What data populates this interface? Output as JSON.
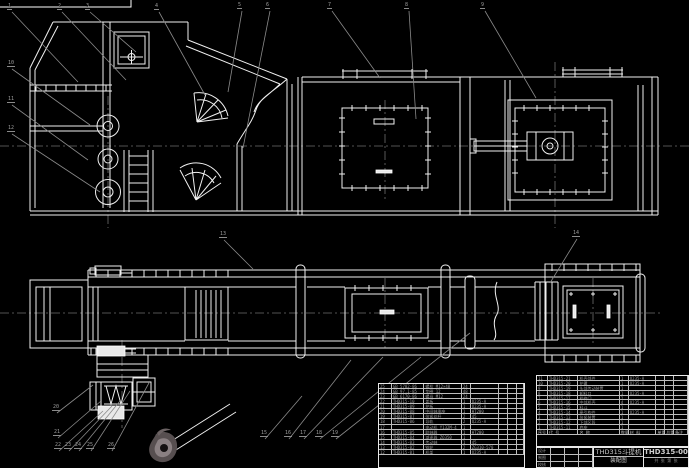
{
  "drawing": {
    "title": "THD315斗提机",
    "subtitle": "装配图",
    "drawing_number": "THD315-00",
    "title_note": "共 张  第 张",
    "colors": {
      "background": "#000000",
      "line": "#f0f0f0",
      "leader": "#8a8a8a",
      "centerline": "#6e6e6e",
      "table_text": "#9a9a9a"
    }
  },
  "title_block": {
    "signature_labels": [
      "设计",
      "制图",
      "校核"
    ]
  },
  "bom_right": {
    "header": [
      "序号",
      "代 号",
      "名 称",
      "数量",
      "材 料",
      "单重",
      "总重",
      "备注"
    ],
    "col_widths": [
      11,
      31,
      42,
      9,
      28,
      9,
      9,
      14
    ],
    "rows": [
      [
        "11",
        "THD315-21",
        "机壳部件",
        "1",
        "Q235-A",
        "",
        "",
        " "
      ],
      [
        "10",
        "THD315-20",
        "护罩",
        "1",
        "Q235-A",
        "",
        "",
        " "
      ],
      [
        "9",
        "THD315-19",
        "头部传动装置",
        "1",
        "",
        "",
        "",
        " "
      ],
      [
        "8",
        "THD315-18",
        "卸料口",
        "1",
        "Q235-A",
        "",
        "",
        " "
      ],
      [
        "7",
        "THD315-17",
        "检修门",
        "2",
        "",
        "",
        "",
        " "
      ],
      [
        "6",
        "THD315-16",
        "中部机壳",
        "4",
        "Q235-A",
        "",
        "",
        " "
      ],
      [
        "5",
        "THD315-15",
        "料斗",
        "1",
        "",
        "",
        "",
        " "
      ],
      [
        "4",
        "THD315-14",
        "牵引构件",
        "1",
        "Q235-A",
        "",
        "",
        " "
      ],
      [
        "3",
        "THD315-13",
        "张紧装置",
        "1",
        "",
        "",
        "",
        " "
      ],
      [
        "2",
        "THD315-12",
        "下部区段",
        "1",
        "",
        "",
        "",
        " "
      ],
      [
        "1",
        "THD315-11",
        "底座",
        "1",
        "",
        "",
        "",
        " "
      ]
    ]
  },
  "bom_left": {
    "col_widths": [
      13,
      33,
      38,
      9,
      29,
      9,
      9,
      7
    ],
    "rows": [
      [
        "25",
        "GB 5782-86",
        "螺栓 M12×40",
        "24",
        "",
        "",
        "",
        " "
      ],
      [
        "24",
        "GB 97.1-85",
        "垫圈 12",
        "48",
        "",
        "",
        "",
        " "
      ],
      [
        "23",
        "GB 6170-86",
        "螺母 M12",
        "24",
        "",
        "",
        "",
        " "
      ],
      [
        "22",
        "THD315-10",
        "盖板",
        "1",
        "Q235-A",
        "",
        "",
        " "
      ],
      [
        "21",
        "THD315-09",
        "护板",
        "1",
        "Q235-A",
        "",
        "",
        " "
      ],
      [
        "20",
        "THD315-08",
        "中间轴承座",
        "1",
        "HT200",
        "",
        "",
        " "
      ],
      [
        "19",
        "THD315-07",
        "张紧丝杆",
        "2",
        "45",
        "",
        "",
        " "
      ],
      [
        "18",
        "THD315-06",
        "导轨",
        "2",
        "Q235-A",
        "",
        "",
        " "
      ],
      [
        "17",
        "",
        "电动机 Y132M-4",
        "1",
        "",
        "",
        "",
        " "
      ],
      [
        "16",
        "THD315-05",
        "联轴器",
        "1",
        "HT200",
        "",
        "",
        " "
      ],
      [
        "15",
        "THD315-04",
        "减速器 ZQ350",
        "1",
        "",
        "",
        "",
        " "
      ],
      [
        "14",
        "THD315-03",
        "传动轴",
        "1",
        "45",
        "",
        "",
        " "
      ],
      [
        "13",
        "THD315-02",
        "链轮",
        "2",
        "ZG310-570",
        "",
        "",
        " "
      ],
      [
        "12",
        "THD315-01",
        "机架",
        "1",
        "Q235-A",
        "",
        "",
        " "
      ]
    ]
  },
  "callouts": [
    {
      "label": "1",
      "x": 10,
      "y": 10,
      "tx": 78,
      "ty": 82
    },
    {
      "label": "2",
      "x": 60,
      "y": 10,
      "tx": 126,
      "ty": 80
    },
    {
      "label": "3",
      "x": 88,
      "y": 10,
      "tx": 136,
      "ty": 52
    },
    {
      "label": "4",
      "x": 157,
      "y": 10,
      "tx": 205,
      "ty": 95
    },
    {
      "label": "5",
      "x": 240,
      "y": 9,
      "tx": 228,
      "ty": 92
    },
    {
      "label": "6",
      "x": 268,
      "y": 9,
      "tx": 243,
      "ty": 148
    },
    {
      "label": "7",
      "x": 330,
      "y": 9,
      "tx": 380,
      "ty": 78
    },
    {
      "label": "8",
      "x": 407,
      "y": 9,
      "tx": 416,
      "ty": 119
    },
    {
      "label": "9",
      "x": 483,
      "y": 9,
      "tx": 536,
      "ty": 98
    },
    {
      "label": "10",
      "x": 10,
      "y": 67,
      "tx": 90,
      "ty": 125
    },
    {
      "label": "11",
      "x": 10,
      "y": 103,
      "tx": 88,
      "ty": 160
    },
    {
      "label": "12",
      "x": 10,
      "y": 132,
      "tx": 100,
      "ty": 192
    },
    {
      "label": "13",
      "x": 222,
      "y": 238,
      "tx": 253,
      "ty": 269
    },
    {
      "label": "14",
      "x": 575,
      "y": 237,
      "tx": 550,
      "ty": 283
    },
    {
      "label": "15",
      "x": 263,
      "y": 437,
      "tx": 302,
      "ty": 396
    },
    {
      "label": "16",
      "x": 287,
      "y": 437,
      "tx": 351,
      "ty": 360
    },
    {
      "label": "17",
      "x": 302,
      "y": 437,
      "tx": 383,
      "ty": 357
    },
    {
      "label": "18",
      "x": 318,
      "y": 437,
      "tx": 421,
      "ty": 357
    },
    {
      "label": "19",
      "x": 334,
      "y": 437,
      "tx": 470,
      "ty": 333
    },
    {
      "label": "20",
      "x": 55,
      "y": 411,
      "tx": 93,
      "ty": 385
    },
    {
      "label": "21",
      "x": 56,
      "y": 436,
      "tx": 101,
      "ty": 401
    },
    {
      "label": "22",
      "x": 57,
      "y": 449,
      "tx": 103,
      "ty": 411
    },
    {
      "label": "23",
      "x": 67,
      "y": 449,
      "tx": 112,
      "ty": 406
    },
    {
      "label": "24",
      "x": 77,
      "y": 449,
      "tx": 120,
      "ty": 401
    },
    {
      "label": "25",
      "x": 89,
      "y": 449,
      "tx": 130,
      "ty": 391
    },
    {
      "label": "26",
      "x": 110,
      "y": 449,
      "tx": 150,
      "ty": 381
    }
  ]
}
